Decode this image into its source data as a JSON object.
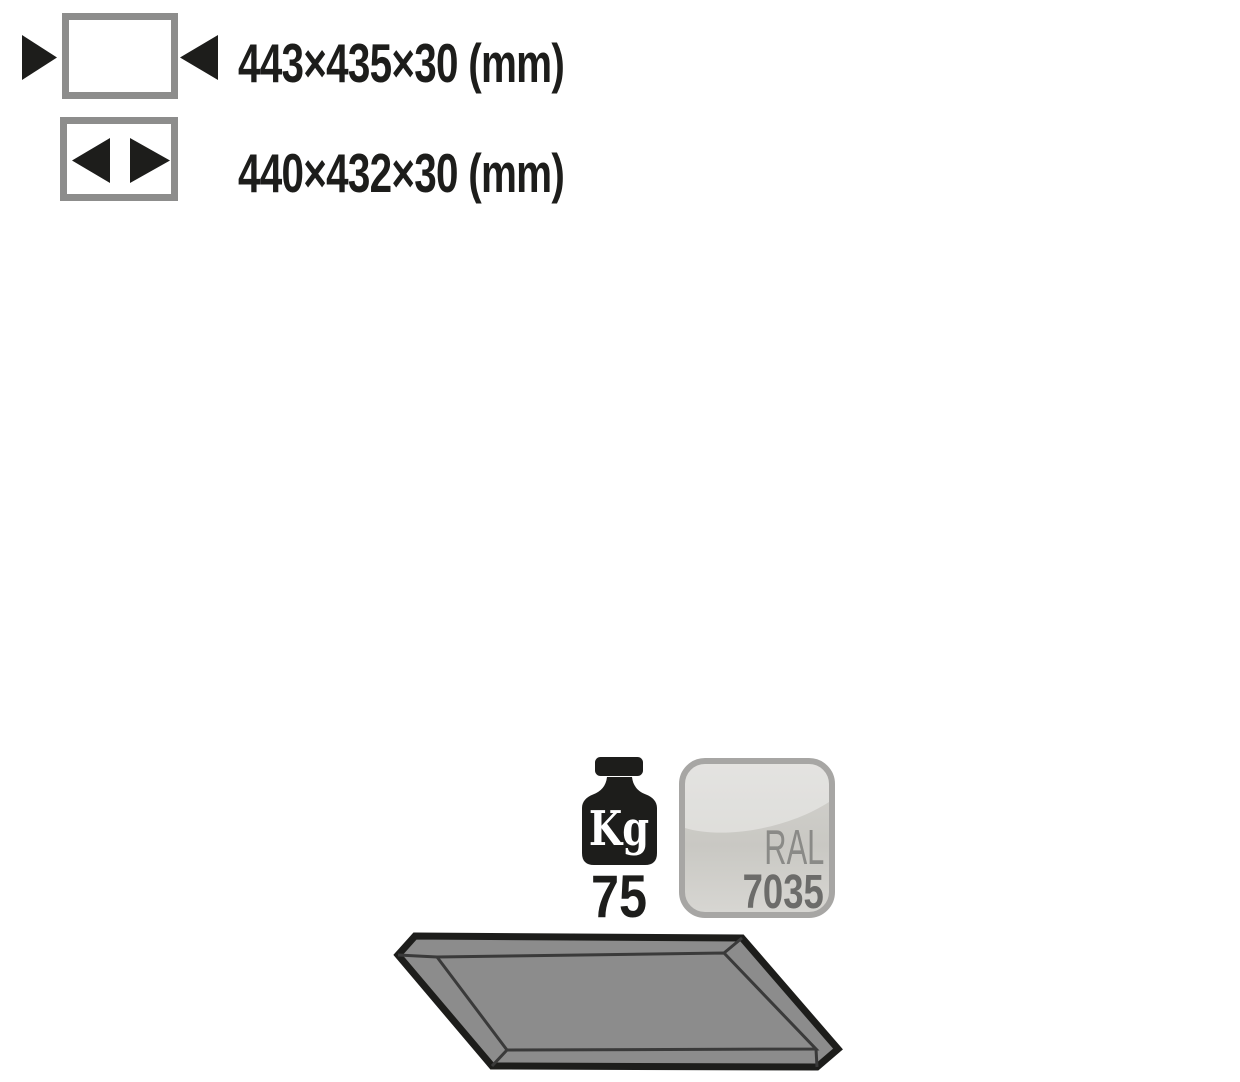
{
  "product_spec": {
    "dimensions": [
      {
        "name": "external-dimensions",
        "value": "443×435×30 (mm)"
      },
      {
        "name": "internal-dimensions",
        "value": "440×432×30 (mm)"
      }
    ],
    "load_capacity": {
      "unit": "Kg",
      "value": "75"
    },
    "color": {
      "system": "RAL",
      "code": "7035"
    },
    "illustration": "grey shelf tray shown in perspective"
  },
  "colors": {
    "background": "#ffffff",
    "text_black": "#1d1d1b",
    "dimension_icon_border": "#8d8d8c",
    "arrow_black": "#1d1d1b",
    "shelf_fill": "#8c8c8c",
    "shelf_outline": "#1d1d1b",
    "shelf_inner_line": "#3a3a3a",
    "badge_border": "#a7a6a4",
    "badge_fill": "#cbcac5",
    "badge_text_light": "#8a8a87",
    "badge_text_dark": "#6c6c6a"
  }
}
